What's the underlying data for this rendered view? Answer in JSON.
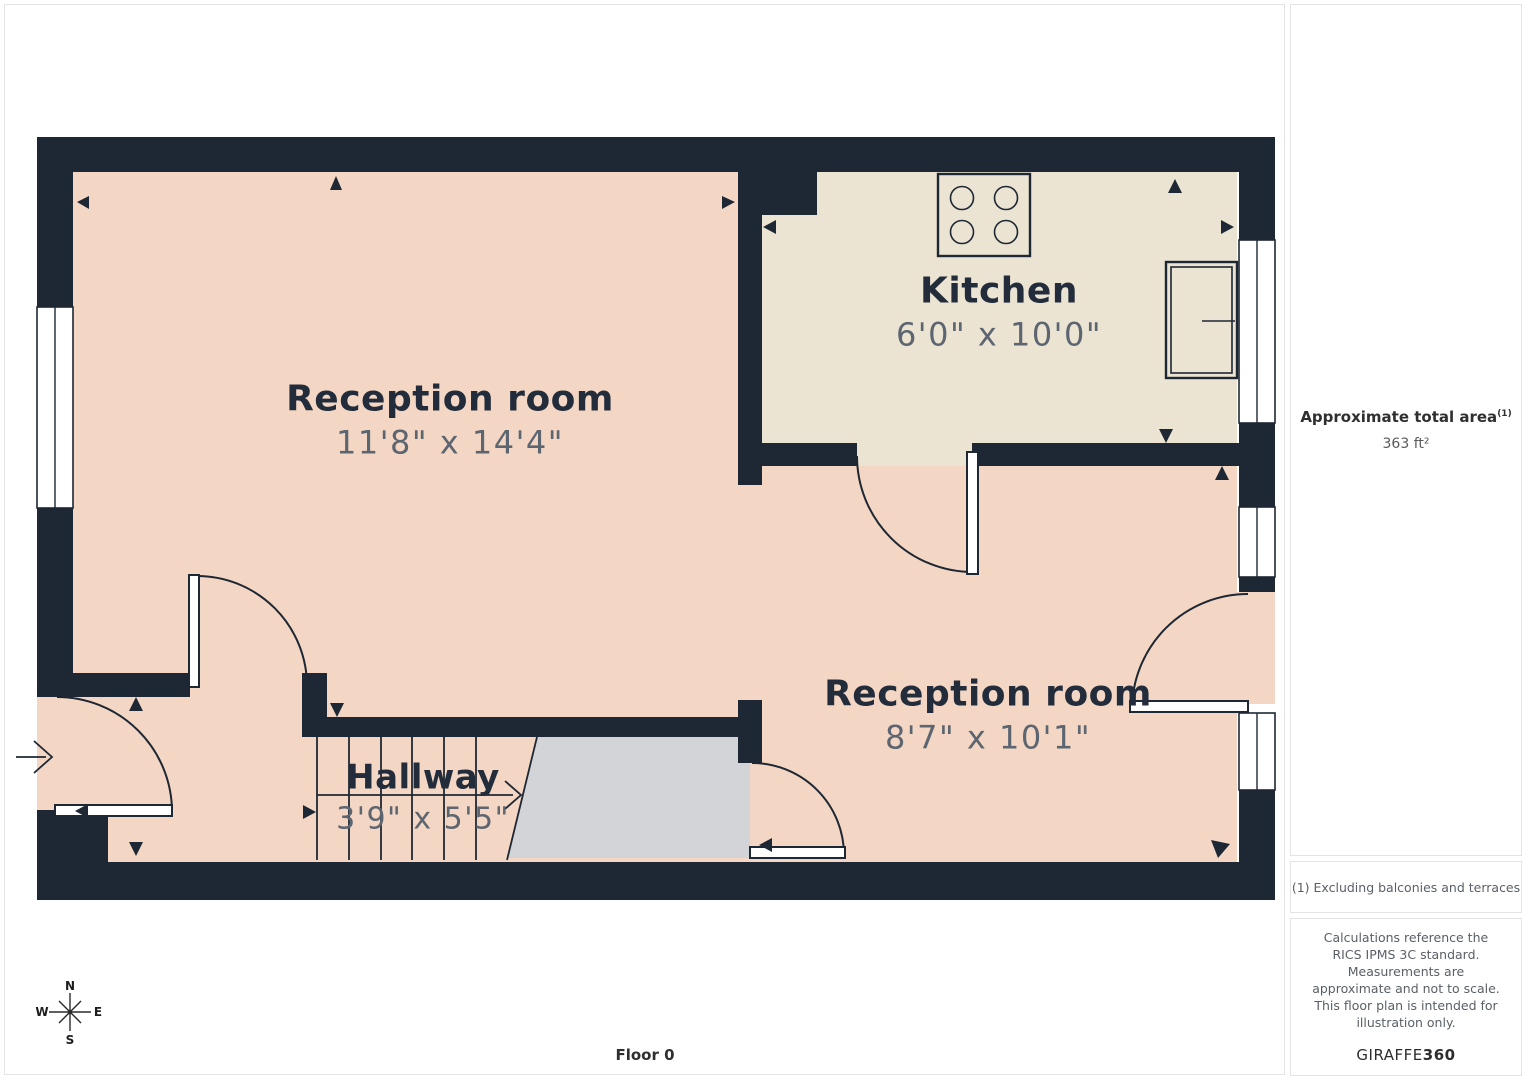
{
  "floor_label": "Floor 0",
  "sidebar": {
    "area_title": "Approximate total area",
    "area_note_ref": "(1)",
    "area_value": "363 ft²",
    "footnote": "(1) Excluding balconies and terraces",
    "disclaimer": "Calculations reference the RICS IPMS 3C standard. Measurements are approximate and not to scale. This floor plan is intended for illustration only.",
    "brand_name": "GIRAFFE",
    "brand_suffix": "360"
  },
  "compass": {
    "north": "N",
    "east": "E",
    "south": "S",
    "west": "W"
  },
  "rooms": {
    "reception1": {
      "name": "Reception room",
      "dims": "11'8\" x 14'4\""
    },
    "kitchen": {
      "name": "Kitchen",
      "dims": "6'0\" x 10'0\""
    },
    "reception2": {
      "name": "Reception room",
      "dims": "8'7\" x 10'1\""
    },
    "hallway": {
      "name": "Hallway",
      "dims": "3'9\" x 5'5\""
    }
  },
  "colors": {
    "wall": "#1e2734",
    "floor_pink": "#f3d7c4",
    "floor_cream": "#ece4d2",
    "stair_void_gray": "#d2d4d7",
    "room_label": "#232c3b",
    "dimension_text": "#5d6570",
    "panel_border": "#e2e4e7",
    "panel_text": "#5a6067",
    "page_bg": "#ffffff"
  }
}
